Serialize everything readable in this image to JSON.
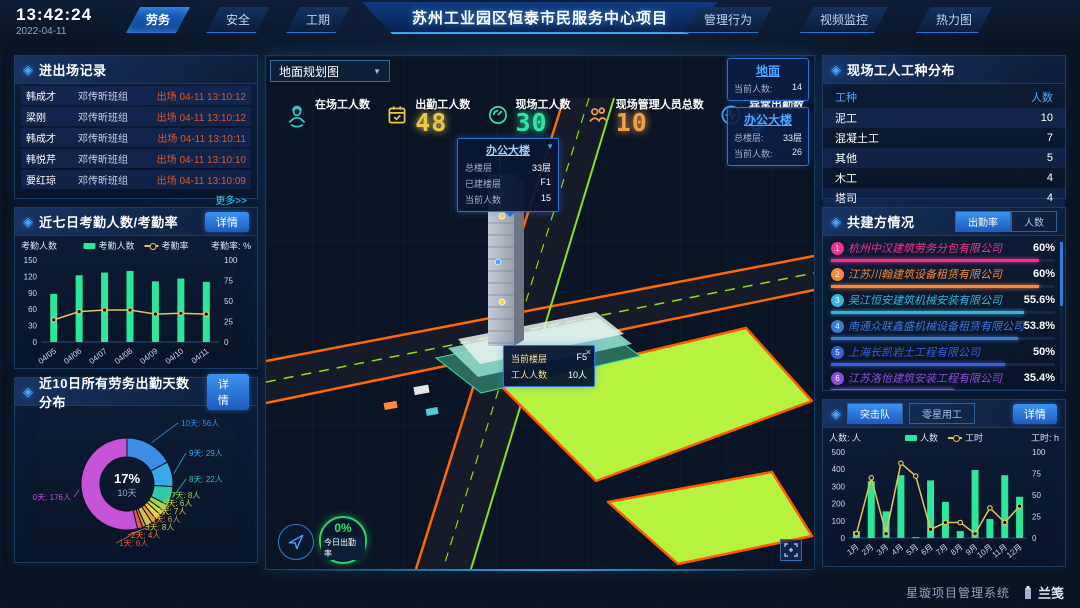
{
  "header": {
    "time": "13:42:24",
    "date": "2022-04-11",
    "title": "苏州工业园区恒泰市民服务中心项目",
    "left_tabs": [
      {
        "label": "劳务",
        "active": true
      },
      {
        "label": "安全",
        "active": false
      },
      {
        "label": "工期",
        "active": false
      }
    ],
    "right_tabs": [
      {
        "label": "管理行为"
      },
      {
        "label": "视频监控"
      },
      {
        "label": "热力图"
      }
    ]
  },
  "entry_exit": {
    "title": "进出场记录",
    "more_label": "更多>>",
    "rows": [
      {
        "name": "韩成才",
        "team": "邓传昕班组",
        "time": "出场 04-11 13:10:12"
      },
      {
        "name": "梁刚",
        "team": "邓传昕班组",
        "time": "出场 04-11 13:10:12"
      },
      {
        "name": "韩成才",
        "team": "邓传昕班组",
        "time": "出场 04-11 13:10:11"
      },
      {
        "name": "韩悦芹",
        "team": "邓传昕班组",
        "time": "出场 04-11 13:10:10"
      },
      {
        "name": "要红琼",
        "team": "邓传昕班组",
        "time": "出场 04-11 13:10:09"
      }
    ]
  },
  "attendance_panel": {
    "detail_label": "详情"
  },
  "distribution_panel": {
    "detail_label": "详情"
  },
  "map": {
    "layer_select": "地面规划图",
    "stats": [
      {
        "label": "在场工人数",
        "value": "",
        "color": "#2ec8c8"
      },
      {
        "label": "出勤工人数",
        "value": "48",
        "color": "#e8c84a"
      },
      {
        "label": "现场工人数",
        "value": "30",
        "color": "#2ee6a6"
      },
      {
        "label": "现场管理人员总数",
        "value": "10",
        "color": "#f09f4b"
      },
      {
        "label": "异常出勤数",
        "value": "0",
        "color": "#3da9f5"
      }
    ],
    "building_tooltip": {
      "title": "办公大楼",
      "rows": [
        {
          "label": "总楼层",
          "value": "33层"
        },
        {
          "label": "已建楼层",
          "value": "F1"
        },
        {
          "label": "当前人数",
          "value": "15"
        }
      ]
    },
    "floor_tooltip": {
      "close": "×",
      "rows": [
        {
          "label": "当前楼层",
          "value": "F5"
        },
        {
          "label": "工人人数",
          "value": "10人"
        }
      ]
    },
    "badges": [
      {
        "title": "地面",
        "rows": [
          {
            "label": "当前人数:",
            "value": "14"
          }
        ]
      },
      {
        "title": "办公大楼",
        "rows": [
          {
            "label": "总楼层:",
            "value": "33层"
          },
          {
            "label": "当前人数:",
            "value": "26"
          }
        ]
      }
    ],
    "gauge": {
      "value": "0%",
      "label": "今日出勤率"
    }
  },
  "worker_types": {
    "title": "现场工人工种分布",
    "headers": [
      "工种",
      "人数"
    ],
    "rows": [
      {
        "type": "泥工",
        "count": "10"
      },
      {
        "type": "混凝土工",
        "count": "7"
      },
      {
        "type": "其他",
        "count": "5"
      },
      {
        "type": "木工",
        "count": "4"
      },
      {
        "type": "塔司",
        "count": "4"
      }
    ]
  },
  "contractors": {
    "title": "共建方情况",
    "tabs": [
      {
        "label": "出勤率",
        "active": true
      },
      {
        "label": "人数",
        "active": false
      }
    ],
    "items": [
      {
        "rank": "1",
        "name": "杭州中汉建筑劳务分包有限公司",
        "value": "60%",
        "pct": 60,
        "color": "#f5338d"
      },
      {
        "rank": "2",
        "name": "江苏川翰建筑设备租赁有限公司",
        "value": "60%",
        "pct": 60,
        "color": "#f5883a"
      },
      {
        "rank": "3",
        "name": "吴江恒安建筑机械安装有限公司",
        "value": "55.6%",
        "pct": 55.6,
        "color": "#35b5d8"
      },
      {
        "rank": "4",
        "name": "南通众联鑫盛机械设备租赁有限公司",
        "value": "53.8%",
        "pct": 53.8,
        "color": "#3a7bd8"
      },
      {
        "rank": "5",
        "name": "上海长凯岩土工程有限公司",
        "value": "50%",
        "pct": 50,
        "color": "#3a5fd8"
      },
      {
        "rank": "6",
        "name": "江苏洛怡建筑安装工程有限公司",
        "value": "35.4%",
        "pct": 35.4,
        "color": "#8a4fd8"
      }
    ]
  },
  "teams_panel": {
    "tabs": [
      {
        "label": "突击队",
        "active": true
      },
      {
        "label": "零星用工",
        "active": false
      }
    ],
    "detail_label": "详情"
  },
  "footer": {
    "system_name": "星璇项目管理系统",
    "logo_text": "兰笺"
  },
  "chart_data": [
    {
      "id": "attendance7",
      "type": "bar+line",
      "title": "近七日考勤人数/考勤率",
      "categories": [
        "04/05",
        "04/06",
        "04/07",
        "04/08",
        "04/09",
        "04/10",
        "04/11"
      ],
      "series": [
        {
          "name": "考勤人数",
          "type": "bar",
          "color": "#2ee69a",
          "axis": "left",
          "values": [
            88,
            122,
            127,
            130,
            111,
            116,
            110
          ]
        },
        {
          "name": "考勤率",
          "type": "line",
          "color": "#e6c35c",
          "axis": "right",
          "values": [
            27,
            37,
            39,
            39,
            34,
            35,
            34
          ]
        }
      ],
      "left_axis": {
        "label": "考勤人数",
        "min": 0,
        "max": 150,
        "ticks": [
          0,
          30,
          60,
          90,
          120,
          150
        ]
      },
      "right_axis": {
        "label": "考勤率: %",
        "min": 0,
        "max": 100,
        "ticks": [
          0,
          25,
          50,
          75,
          100
        ]
      }
    },
    {
      "id": "distribution10",
      "type": "pie",
      "title": "近10日所有劳务出勤天数分布",
      "center": {
        "pct": "17%",
        "label": "10天"
      },
      "slices": [
        {
          "label": "10天: 56人",
          "value": 56,
          "color": "#3a8ee6"
        },
        {
          "label": "9天: 29人",
          "value": 29,
          "color": "#3aa8e8"
        },
        {
          "label": "8天: 22人",
          "value": 22,
          "color": "#30c8a8"
        },
        {
          "label": "7天: 8人",
          "value": 8,
          "color": "#a0d44c"
        },
        {
          "label": "6天: 6人",
          "value": 6,
          "color": "#c6d843"
        },
        {
          "label": "5天: 7人",
          "value": 7,
          "color": "#e8d44a"
        },
        {
          "label": "4天: 6人",
          "value": 6,
          "color": "#e89a3c"
        },
        {
          "label": "3天: 8人",
          "value": 8,
          "color": "#d4c24a"
        },
        {
          "label": "2天: 4人",
          "value": 4,
          "color": "#e87a50"
        },
        {
          "label": "1天: 6人",
          "value": 6,
          "color": "#e05a4a"
        },
        {
          "label": "0天: 176人",
          "value": 176,
          "color": "#c653d8"
        }
      ]
    },
    {
      "id": "teams_monthly",
      "type": "bar+line",
      "title": "突击队",
      "categories": [
        "1月",
        "2月",
        "3月",
        "4月",
        "5月",
        "6月",
        "7月",
        "8月",
        "9月",
        "10月",
        "11月",
        "12月"
      ],
      "series": [
        {
          "name": "人数",
          "type": "bar",
          "color": "#2ee69a",
          "axis": "left",
          "values": [
            40,
            330,
            155,
            365,
            5,
            335,
            210,
            40,
            395,
            110,
            365,
            240
          ]
        },
        {
          "name": "工时",
          "type": "line",
          "color": "#e6c35c",
          "axis": "right",
          "values": [
            5,
            70,
            5,
            87,
            72,
            10,
            18,
            18,
            5,
            35,
            18,
            37
          ]
        }
      ],
      "left_axis": {
        "label": "人数: 人",
        "min": 0,
        "max": 500,
        "ticks": [
          0,
          100,
          200,
          300,
          400,
          500
        ]
      },
      "right_axis": {
        "label": "工时: h",
        "min": 0,
        "max": 100,
        "ticks": [
          0,
          25,
          50,
          75,
          100
        ]
      }
    }
  ]
}
